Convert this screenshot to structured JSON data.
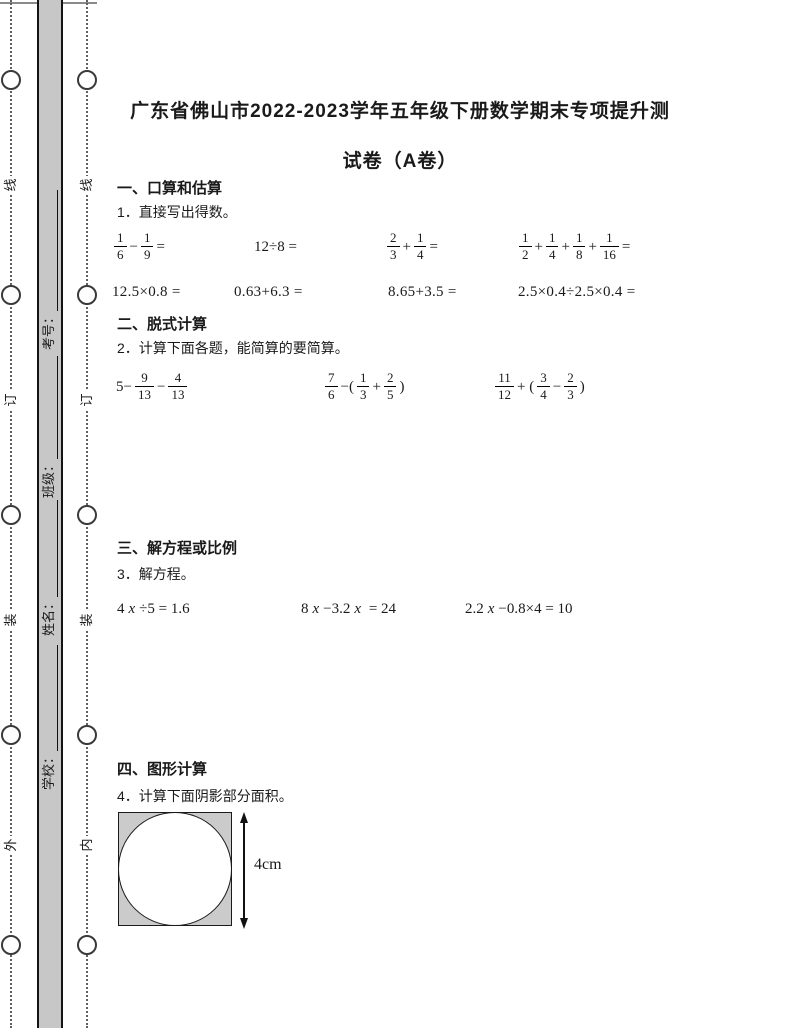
{
  "header": {
    "title_line1": "广东省佛山市2022-2023学年五年级下册数学期末专项提升测",
    "title_line2": "试卷（A卷）"
  },
  "margin": {
    "outer_fold_labels": [
      "线",
      "订",
      "装",
      "外"
    ],
    "inner_fold_labels": [
      "线",
      "订",
      "装",
      "内"
    ],
    "student_fields": [
      {
        "label": "学校："
      },
      {
        "label": "姓名："
      },
      {
        "label": "班级："
      },
      {
        "label": "考号："
      }
    ]
  },
  "sections": [
    {
      "heading": "一、口算和估算",
      "instruction": "1．直接写出得数。"
    },
    {
      "heading": "二、脱式计算",
      "instruction": "2．计算下面各题，能简算的要简算。"
    },
    {
      "heading": "三、解方程或比例",
      "instruction": "3．解方程。"
    },
    {
      "heading": "四、图形计算",
      "instruction": "4．计算下面阴影部分面积。"
    }
  ],
  "math": {
    "mental_row1": [
      [
        {
          "f": [
            "1",
            "6"
          ]
        },
        {
          "o": "−"
        },
        {
          "f": [
            "1",
            "9"
          ]
        },
        {
          "o": "="
        }
      ],
      [
        {
          "o": "12÷8 ="
        }
      ],
      [
        {
          "f": [
            "2",
            "3"
          ]
        },
        {
          "o": "+"
        },
        {
          "f": [
            "1",
            "4"
          ]
        },
        {
          "o": "="
        }
      ],
      [
        {
          "f": [
            "1",
            "2"
          ]
        },
        {
          "o": "+"
        },
        {
          "f": [
            "1",
            "4"
          ]
        },
        {
          "o": "+"
        },
        {
          "f": [
            "1",
            "8"
          ]
        },
        {
          "o": "+"
        },
        {
          "f": [
            "1",
            "16"
          ]
        },
        {
          "o": "="
        }
      ]
    ],
    "mental_row2": [
      "12.5×0.8 =",
      "0.63+6.3 =",
      "8.65+3.5 =",
      "2.5×0.4÷2.5×0.4 ="
    ],
    "simplify_row": [
      [
        {
          "o": "5−"
        },
        {
          "f": [
            "9",
            "13"
          ]
        },
        {
          "o": "−"
        },
        {
          "f": [
            "4",
            "13"
          ]
        }
      ],
      [
        {
          "f": [
            "7",
            "6"
          ]
        },
        {
          "o": "−("
        },
        {
          "f": [
            "1",
            "3"
          ]
        },
        {
          "o": "+"
        },
        {
          "f": [
            "2",
            "5"
          ]
        },
        {
          "o": ")"
        }
      ],
      [
        {
          "f": [
            "11",
            "12"
          ]
        },
        {
          "o": "+ ("
        },
        {
          "f": [
            "3",
            "4"
          ]
        },
        {
          "o": "−"
        },
        {
          "f": [
            "2",
            "3"
          ]
        },
        {
          "o": ")"
        }
      ]
    ],
    "equations": [
      [
        {
          "o": "4"
        },
        {
          "v": "x"
        },
        {
          "o": "÷5 = 1.6"
        }
      ],
      [
        {
          "o": "8"
        },
        {
          "v": "x"
        },
        {
          "o": "−3.2"
        },
        {
          "v": "x"
        },
        {
          "o": " = 24"
        }
      ],
      [
        {
          "o": "2.2"
        },
        {
          "v": "x"
        },
        {
          "o": "−0.8×4 = 10"
        }
      ]
    ]
  },
  "figure": {
    "dimension_label": "4cm"
  },
  "colors": {
    "bar_fill": "#c7c7c7",
    "square_fill": "#cbcbcb",
    "ink": "#1a1a1a"
  }
}
